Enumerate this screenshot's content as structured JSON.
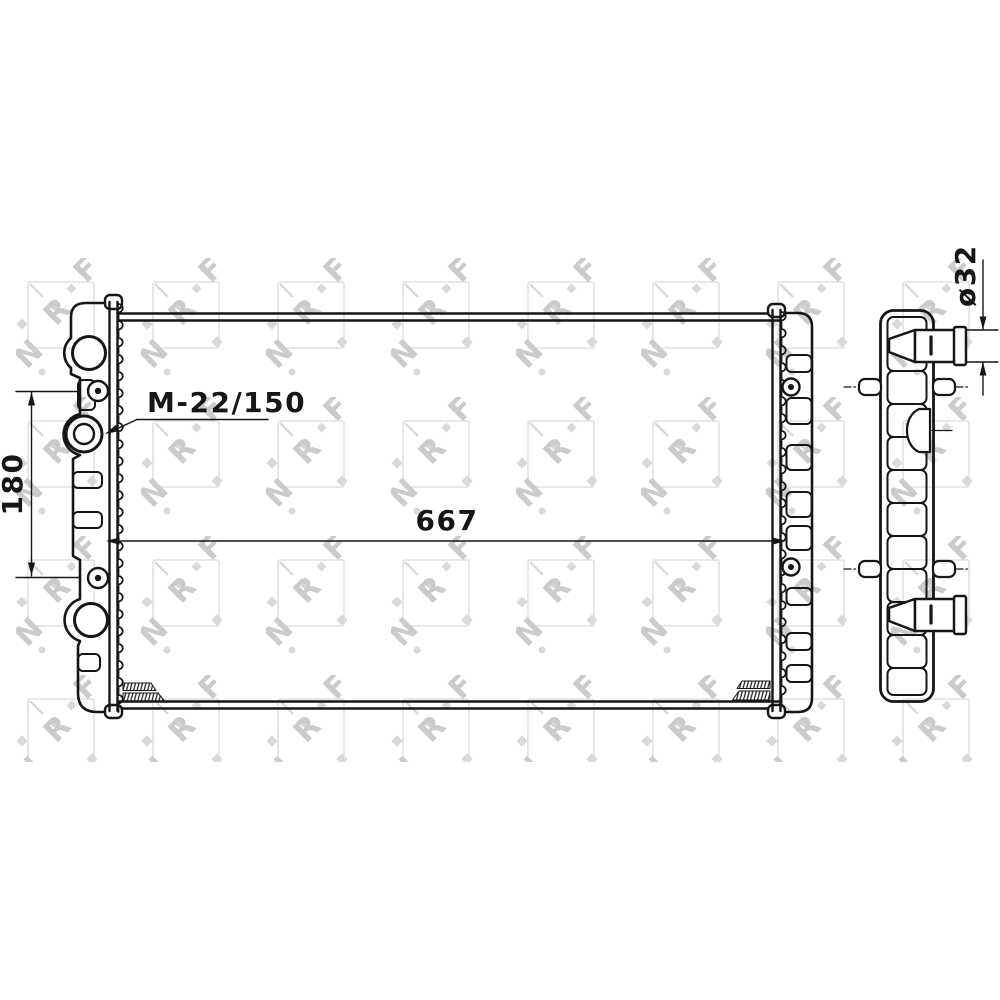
{
  "drawing_labels": {
    "thread_spec": "M-22/150",
    "core_width": "667",
    "pin_spacing": "180",
    "pipe_diameter": "ø32"
  },
  "watermark": {
    "letters": [
      "N",
      "R",
      "F"
    ],
    "square_color": "#e1e1e1",
    "mark_color": "#d6d6d6",
    "text_color": "#cbcbcb"
  },
  "colors": {
    "line": "#161616",
    "background": "#ffffff"
  }
}
